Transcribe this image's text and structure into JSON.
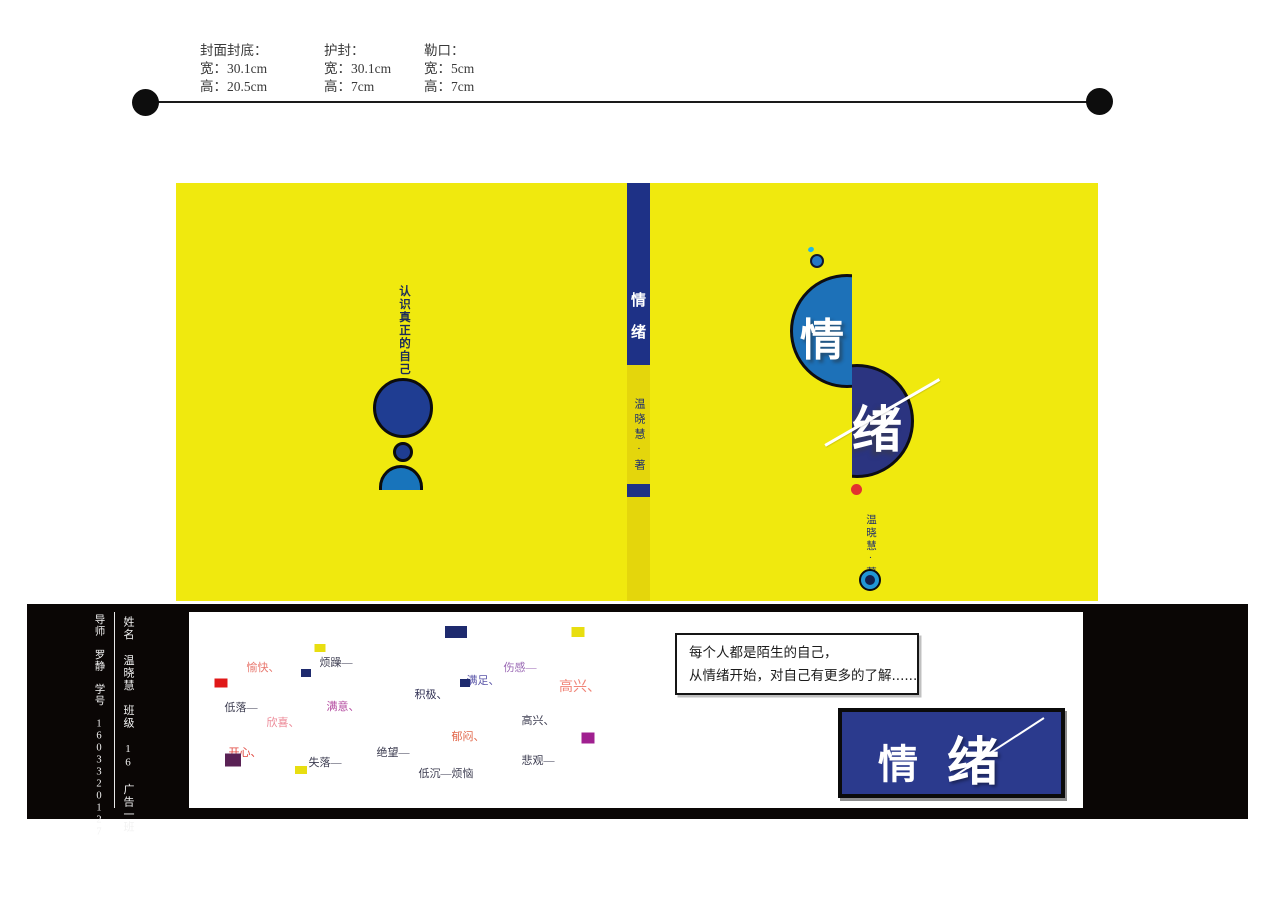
{
  "specs": {
    "columns": [
      {
        "title": "封面封底：",
        "line1": "宽：30.1cm",
        "line2": "高：20.5cm"
      },
      {
        "title": "护封：",
        "line1": "宽：30.1cm",
        "line2": "高：7cm"
      },
      {
        "title": "勒口：",
        "line1": "宽：5cm",
        "line2": "高：7cm"
      }
    ]
  },
  "back_cover": {
    "tagline": "认识真正的自己"
  },
  "spine": {
    "char1": "情",
    "char2": "绪",
    "author": "温晓慧·著"
  },
  "front_cover": {
    "char1": "情",
    "char2": "绪",
    "author": "温晓慧·著"
  },
  "jacket": {
    "credits_left": "导师 罗静　学号 1603320127",
    "credits_right": "姓名 温晓慧　班级 16 广告一班",
    "quote_line1": "每个人都是陌生的自己，",
    "quote_line2": "从情绪开始，对自己有更多的了解......",
    "logo_char1": "情",
    "logo_char2": "绪",
    "words": [
      {
        "text": "愉快、",
        "x": 74,
        "y": 55,
        "color": "#e8776e"
      },
      {
        "text": "烦躁—",
        "x": 147,
        "y": 50,
        "color": "#3c3c50"
      },
      {
        "text": "低落—",
        "x": 52,
        "y": 95,
        "color": "#3c3c50"
      },
      {
        "text": "欣喜、",
        "x": 94,
        "y": 110,
        "color": "#ec8896"
      },
      {
        "text": "满意、",
        "x": 154,
        "y": 94,
        "color": "#b44ca0"
      },
      {
        "text": "开心、",
        "x": 56,
        "y": 140,
        "color": "#e0443c"
      },
      {
        "text": "失落—",
        "x": 136,
        "y": 150,
        "color": "#3c3c50"
      },
      {
        "text": "绝望—",
        "x": 204,
        "y": 140,
        "color": "#3c3c50"
      },
      {
        "text": "积极、",
        "x": 242,
        "y": 82,
        "color": "#2e2e52"
      },
      {
        "text": "满足、",
        "x": 294,
        "y": 68,
        "color": "#5a55a8"
      },
      {
        "text": "伤感—",
        "x": 331,
        "y": 55,
        "color": "#9a68b4"
      },
      {
        "text": "高兴、",
        "x": 391,
        "y": 74,
        "color": "#f08578",
        "size": 14
      },
      {
        "text": "高兴、",
        "x": 349,
        "y": 108,
        "color": "#3c3c50"
      },
      {
        "text": "郁闷、",
        "x": 279,
        "y": 124,
        "color": "#e2674a"
      },
      {
        "text": "悲观—",
        "x": 349,
        "y": 148,
        "color": "#3c3c50"
      },
      {
        "text": "低沉—烦恼",
        "x": 257,
        "y": 161,
        "color": "#3c3c50"
      }
    ],
    "squares": [
      {
        "x": 131,
        "y": 36,
        "w": 11,
        "h": 8,
        "color": "#e8de10"
      },
      {
        "x": 117,
        "y": 61,
        "w": 10,
        "h": 8,
        "color": "#1e2a6e"
      },
      {
        "x": 32,
        "y": 71,
        "w": 13,
        "h": 9,
        "color": "#e01818"
      },
      {
        "x": 44,
        "y": 148,
        "w": 16,
        "h": 13,
        "color": "#5a2255"
      },
      {
        "x": 112,
        "y": 158,
        "w": 12,
        "h": 8,
        "color": "#e8de10"
      },
      {
        "x": 267,
        "y": 20,
        "w": 22,
        "h": 12,
        "color": "#1e2a6e"
      },
      {
        "x": 389,
        "y": 20,
        "w": 13,
        "h": 10,
        "color": "#e8de10"
      },
      {
        "x": 276,
        "y": 71,
        "w": 10,
        "h": 8,
        "color": "#1e2a6e"
      },
      {
        "x": 399,
        "y": 126,
        "w": 13,
        "h": 11,
        "color": "#a02090"
      }
    ]
  },
  "colors": {
    "cover_yellow": "#f0e90e",
    "spine_yellow": "#e4d60c",
    "spine_blue": "#1e3186",
    "head_blue": "#1f3d92",
    "shoulder_blue": "#1874bb",
    "semi_left_blue": "#1d71b8",
    "semi_right_navy": "#2b3480",
    "logo_navy": "#2b3a8d",
    "band_black": "#0a0605",
    "red_dot": "#e23230",
    "target_blue": "#2196d6"
  }
}
